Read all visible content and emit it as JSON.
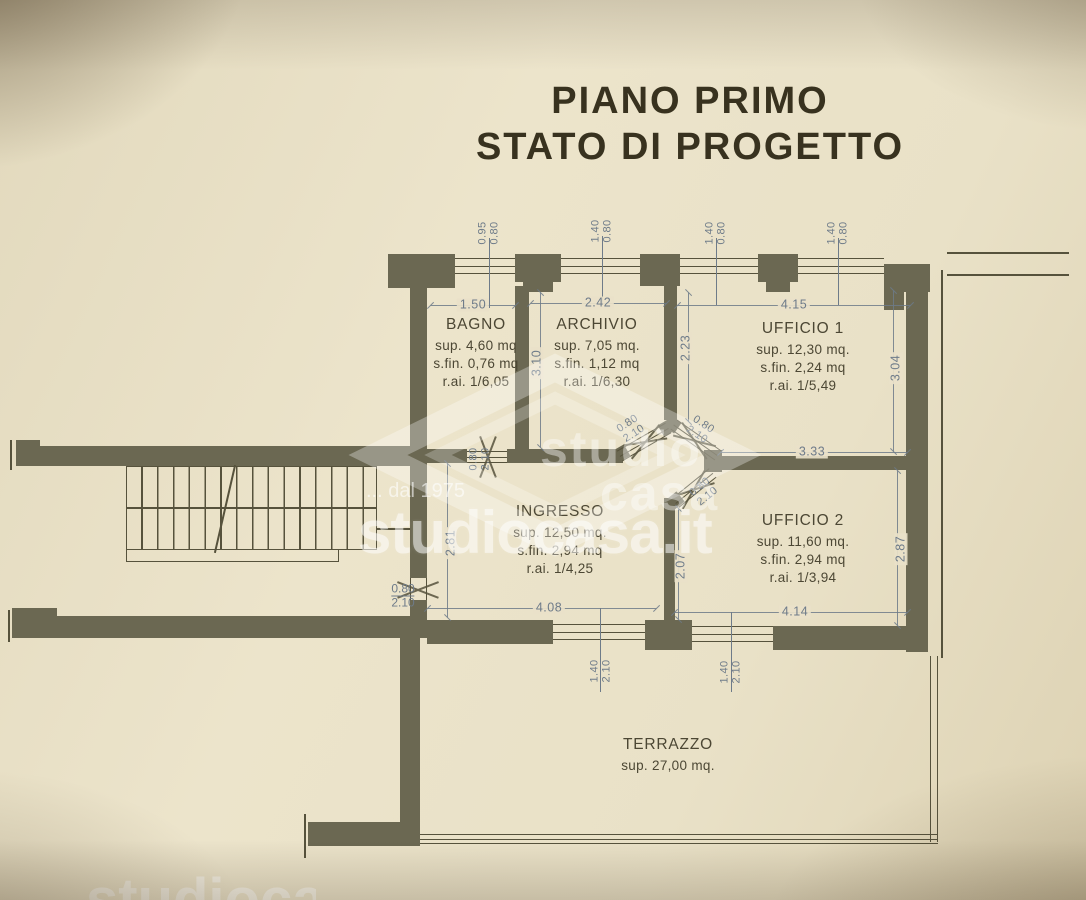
{
  "title": {
    "line1": "PIANO PRIMO",
    "line2": "STATO DI PROGETTO"
  },
  "watermark": {
    "brand_top": "studio",
    "brand_bottom": "casa",
    "tagline": "... dal 1975",
    "domain": "studiocasa.it"
  },
  "rooms": [
    {
      "name": "BAGNO",
      "sup": "sup. 4,60 mq",
      "sfin": "s.fin. 0,76 mq",
      "rai": "r.ai. 1/6,05"
    },
    {
      "name": "ARCHIVIO",
      "sup": "sup. 7,05 mq.",
      "sfin": "s.fin. 1,12 mq",
      "rai": "r.ai. 1/6,30"
    },
    {
      "name": "UFFICIO 1",
      "sup": "sup. 12,30 mq.",
      "sfin": "s.fin. 2,24 mq",
      "rai": "r.ai. 1/5,49"
    },
    {
      "name": "UFFICIO 2",
      "sup": "sup. 11,60 mq.",
      "sfin": "s.fin. 2,94 mq",
      "rai": "r.ai. 1/3,94"
    },
    {
      "name": "INGRESSO",
      "sup": "sup. 12,50 mq.",
      "sfin": "s.fin. 2,94 mq",
      "rai": "r.ai. 1/4,25"
    },
    {
      "name": "TERRAZZO",
      "sup": "sup. 27,00 mq."
    }
  ],
  "dims": {
    "w_bagno": "1.50",
    "w_archivio": "2.42",
    "w_ufficio1": "4.15",
    "w_uffici_divider": "3.33",
    "w_ingresso_bottom": "4.08",
    "w_ufficio2_bottom": "4.14",
    "h_bagno": "3.10",
    "h_hall": "2.23",
    "h_ufficio1": "3.04",
    "h_ingresso": "2.81",
    "h_vestibolo": "2.07",
    "h_ufficio2": "2.87",
    "win_bagno": {
      "w": "0.95",
      "h": "0.80"
    },
    "win_top": {
      "w": "1.40",
      "h": "0.80"
    },
    "door": {
      "w": "0.80",
      "h": "2.10"
    },
    "portafinestra": {
      "w": "1.40",
      "h": "2.10"
    }
  },
  "colors": {
    "paper": "#e8e0c6",
    "wall": "#6b6852",
    "thin": "#56523c",
    "dim": "#6e7b89",
    "ink": "#4c4734",
    "title": "#38321f",
    "watermark": "#ffffff"
  }
}
